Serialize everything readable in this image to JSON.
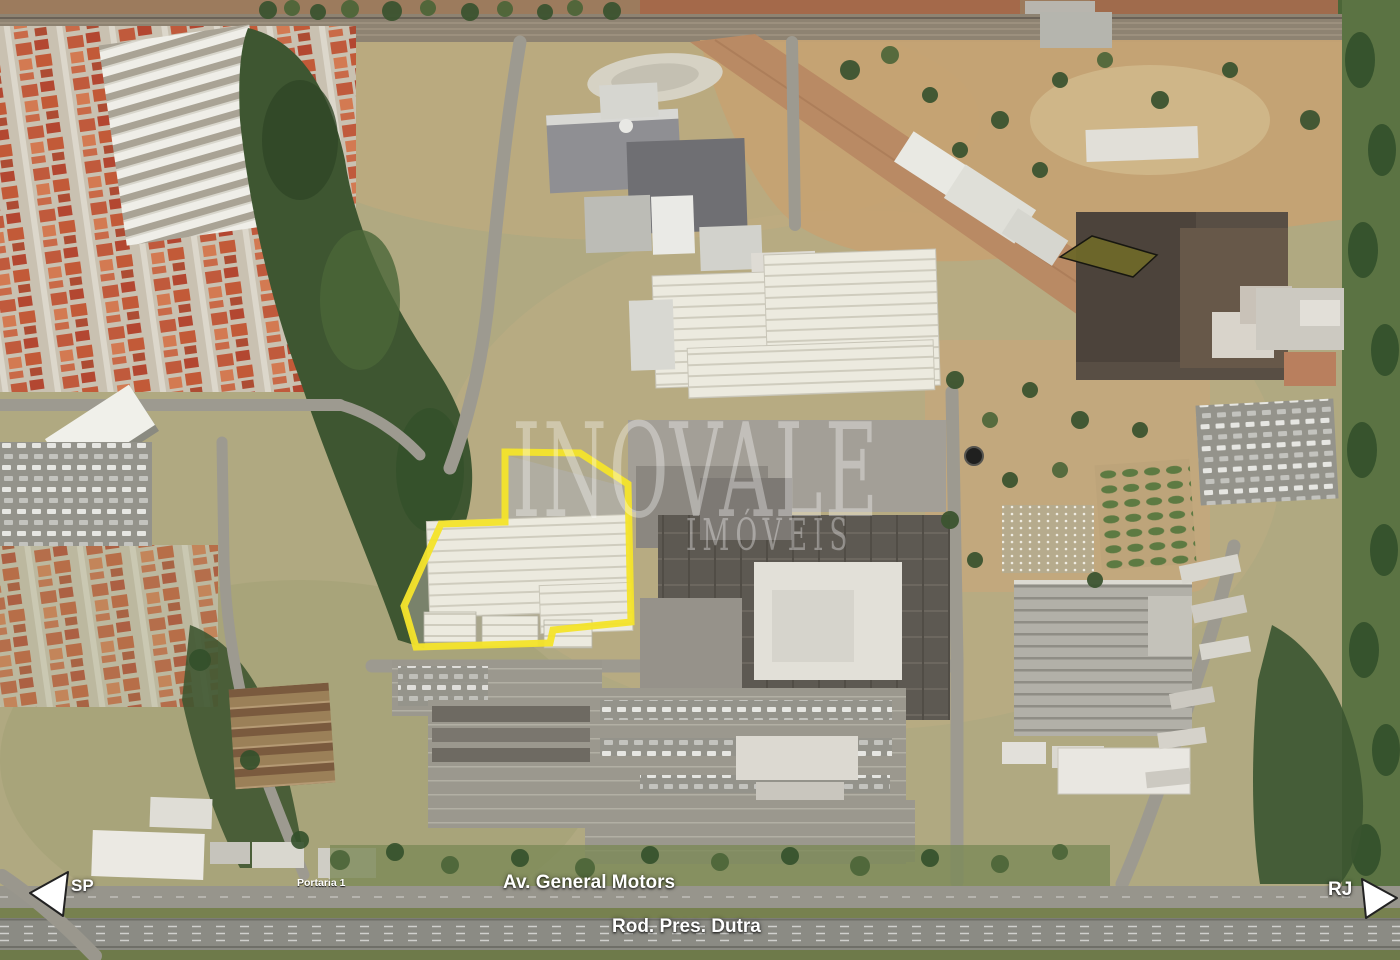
{
  "labels": {
    "avenue": "Av. General Motors",
    "highway": "Rod. Pres. Dutra",
    "gate": "Portaria 1",
    "direction_left": "SP",
    "direction_right": "RJ"
  },
  "watermark": {
    "line1": "INOVALE",
    "line2": "IMÓVEIS"
  },
  "colors": {
    "property_highlight": "#F4E32C",
    "parcel_highlight": "#6E682A",
    "arrow_fill": "#FFFFFF",
    "label_text": "#FFFFFF"
  },
  "icons": {
    "direction_left_arrow": "left-pointing-triangle",
    "direction_right_arrow": "right-pointing-triangle"
  }
}
